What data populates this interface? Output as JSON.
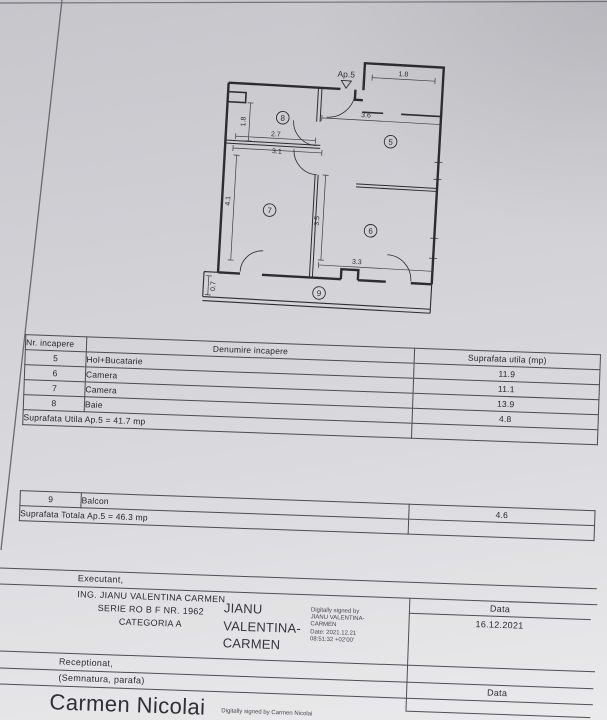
{
  "document": {
    "floor_plan": {
      "apartment_label": "Ap.5",
      "rooms": {
        "r5": "5",
        "r6": "6",
        "r7": "7",
        "r8": "8",
        "r9": "9"
      },
      "dims": {
        "extension_width": "1.8",
        "hall_width": "3.6",
        "bath_height": "1.8",
        "bath_width_inner": "2.7",
        "bath_width_outer": "3.1",
        "room7_height": "4.1",
        "room6_height": "3.5",
        "room6_width": "3.3",
        "balcony_depth": "0.7"
      }
    },
    "rooms_table": {
      "col_nr": "Nr. incapere",
      "col_name": "Denumire incapere",
      "col_area": "Suprafata utila (mp)",
      "rows": [
        {
          "nr": "5",
          "name": "Hol+Bucatarie",
          "area": "11.9"
        },
        {
          "nr": "6",
          "name": "Camera",
          "area": "11.1"
        },
        {
          "nr": "7",
          "name": "Camera",
          "area": "13.9"
        },
        {
          "nr": "8",
          "name": "Baie",
          "area": "4.8"
        }
      ],
      "total": "Suprafata Utila Ap.5 = 41.7 mp"
    },
    "balcony_table": {
      "row": {
        "nr": "9",
        "name": "Balcon",
        "area": "4.6"
      },
      "total": "Suprafata Totala Ap.5 = 46.3 mp"
    },
    "executant": {
      "label": "Executant,",
      "name_line": "ING. JIANU VALENTINA CARMEN",
      "serie_line": "SERIE RO B F  NR. 1962",
      "categoria_line": "CATEGORIA A",
      "signature_name": "JIANU VALENTINA-CARMEN",
      "signature_details": "Digitally signed by\nJIANU VALENTINA-\nCARMEN\nDate: 2021.12.21\n08:51:32 +02'00'",
      "data_label": "Data",
      "date": "16.12.2021"
    },
    "receptionat": {
      "label": "Receptionat,",
      "sub_label": "(Semnatura, parafa)",
      "data_label": "Data",
      "signature_name": "Carmen Nicolai",
      "signature_details": "Digitally signed by Carmen Nicolai"
    }
  }
}
